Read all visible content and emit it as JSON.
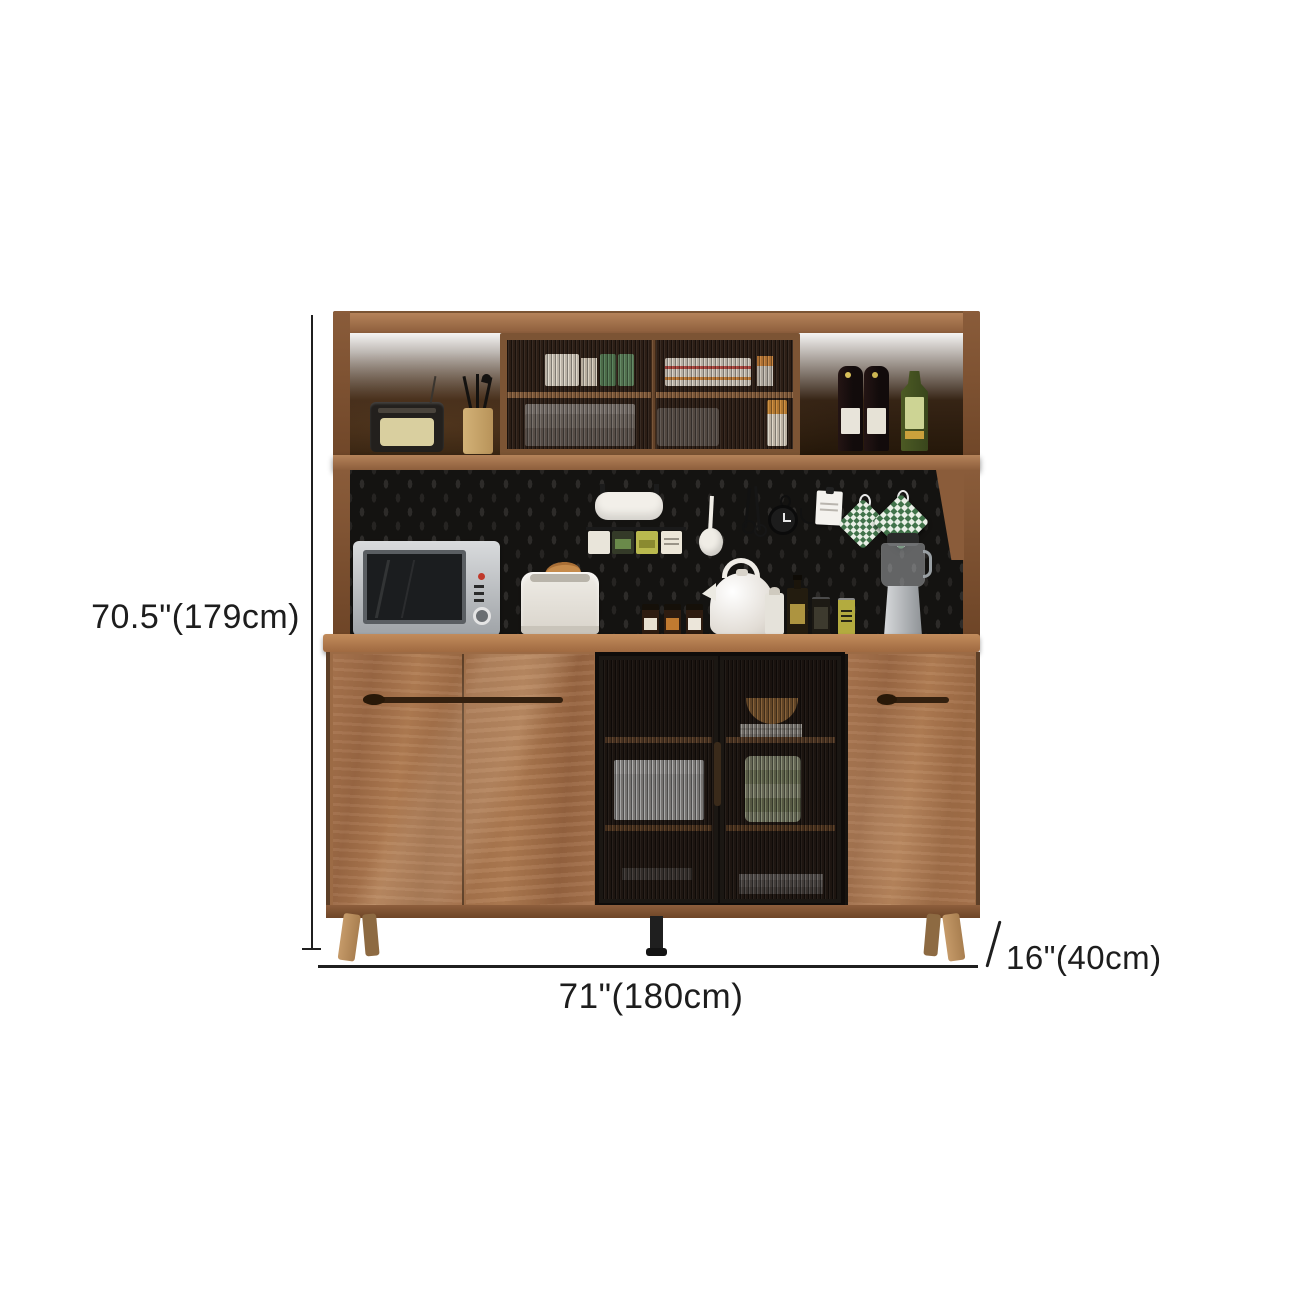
{
  "product_photo": {
    "annotations": {
      "height_label": "70.5\"(179cm)",
      "width_label": "71\"(180cm)",
      "depth_label": "16\"(40cm)"
    },
    "colors": {
      "background": "#ffffff",
      "dimension_lines": "#1f1f1f",
      "wood_frame": "#9c6b45",
      "wood_light": "#b5835a",
      "interior_dark": "#2c1d13",
      "pegboard": "#141311",
      "glass_door_frame": "#17130f",
      "leg_wood": "#b08756",
      "center_leg": "#1d1d1d"
    },
    "items": [
      "radio",
      "utensil-holder",
      "glass-display-case",
      "wine-bottles",
      "liquor-bottle",
      "paper-towel-roll",
      "spice-jars",
      "ladle",
      "kitchen-shears",
      "timer-clock",
      "memo-pad",
      "pot-holders",
      "microwave",
      "toaster",
      "bread",
      "spice-bottles",
      "kettle",
      "shaker",
      "oil-bottle",
      "beverage-cans",
      "blender",
      "dish-storage"
    ]
  }
}
